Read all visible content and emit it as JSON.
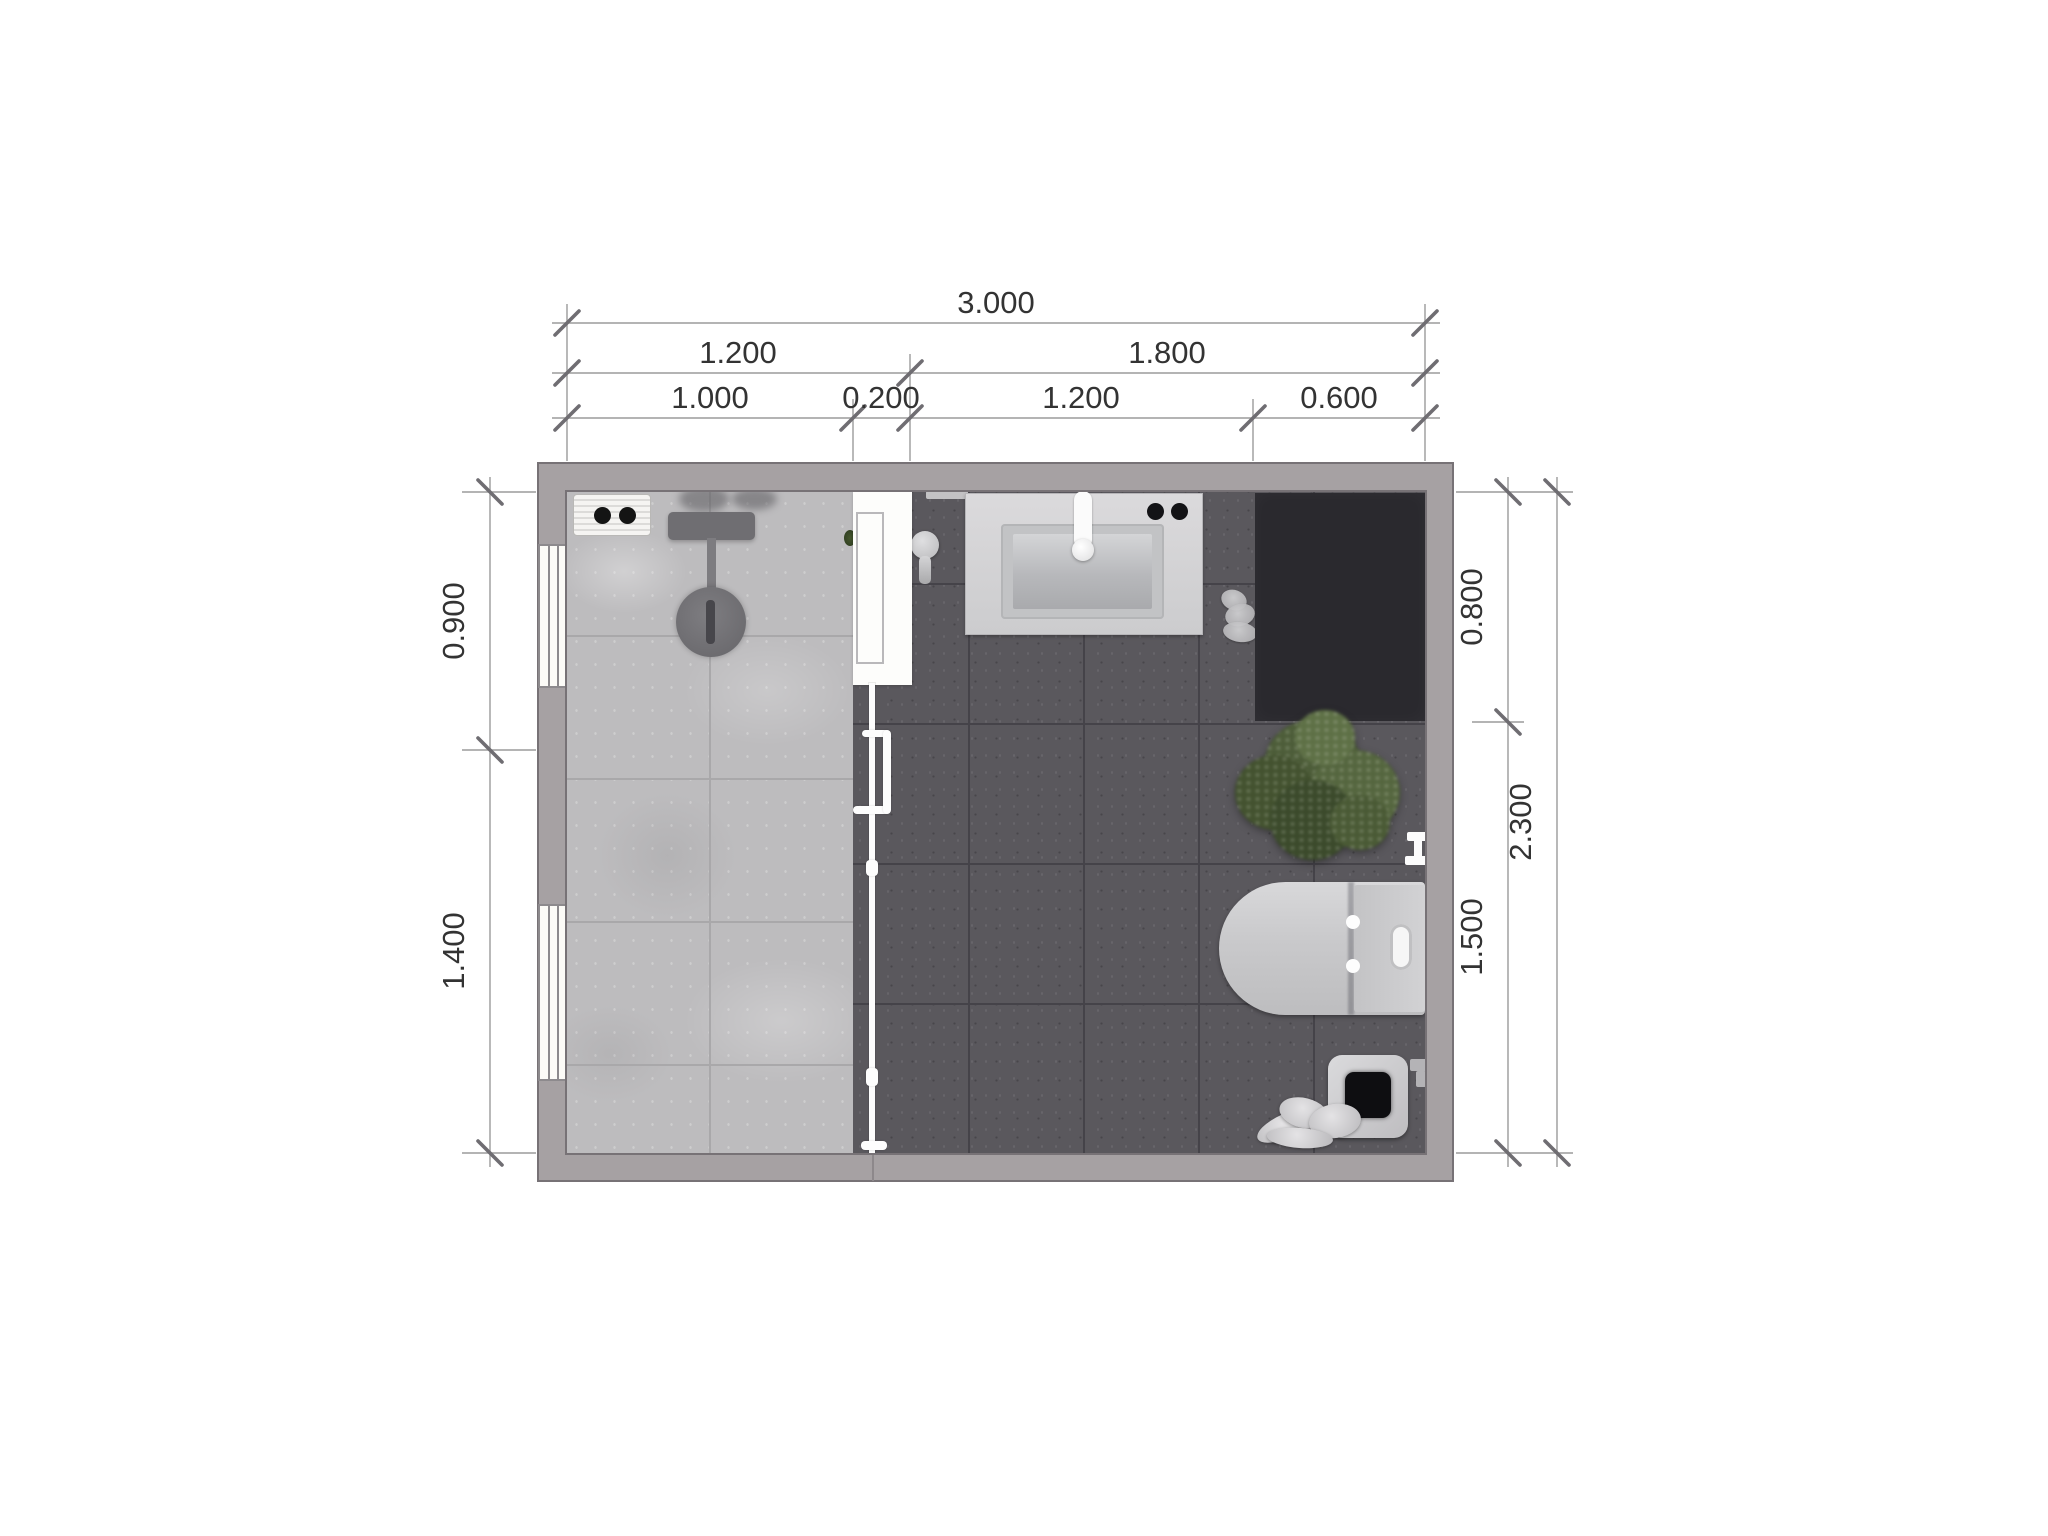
{
  "title": "Bathroom floor plan",
  "dimensions": {
    "top": {
      "total": "3.000",
      "row2": [
        "1.200",
        "1.800"
      ],
      "row3": [
        "1.000",
        "0.200",
        "1.200",
        "0.600"
      ]
    },
    "left": [
      "0.900",
      "1.400"
    ],
    "right": {
      "segments": [
        "0.800",
        "1.500"
      ],
      "total": "2.300"
    }
  },
  "fixtures": [
    "shower-control-panel-icon",
    "shower-rail-icon",
    "rain-shower-head-icon",
    "glass-partition-icon",
    "sliding-door-icon",
    "door-handle-icon",
    "squeegee-icon",
    "wall-shelf-icon",
    "washbasin-vanity-icon",
    "faucet-icon",
    "storage-unit-icon",
    "potted-plant-icon",
    "toilet-paper-holder-icon",
    "toilet-icon",
    "waste-bin-icon",
    "towel-icon",
    "window-icon"
  ],
  "colors": {
    "wall": "#a6a1a3",
    "wallLine": "#777276",
    "floorLight": "#bdbcbe",
    "floorLightLine": "#a9a8aa",
    "floorDark": "#5a585d",
    "floorDarkLine": "#454349",
    "blackUnit": "#2a292e",
    "dimLine": "#9b9b9b",
    "tick": "#6f6d72",
    "dimText": "#333333"
  }
}
